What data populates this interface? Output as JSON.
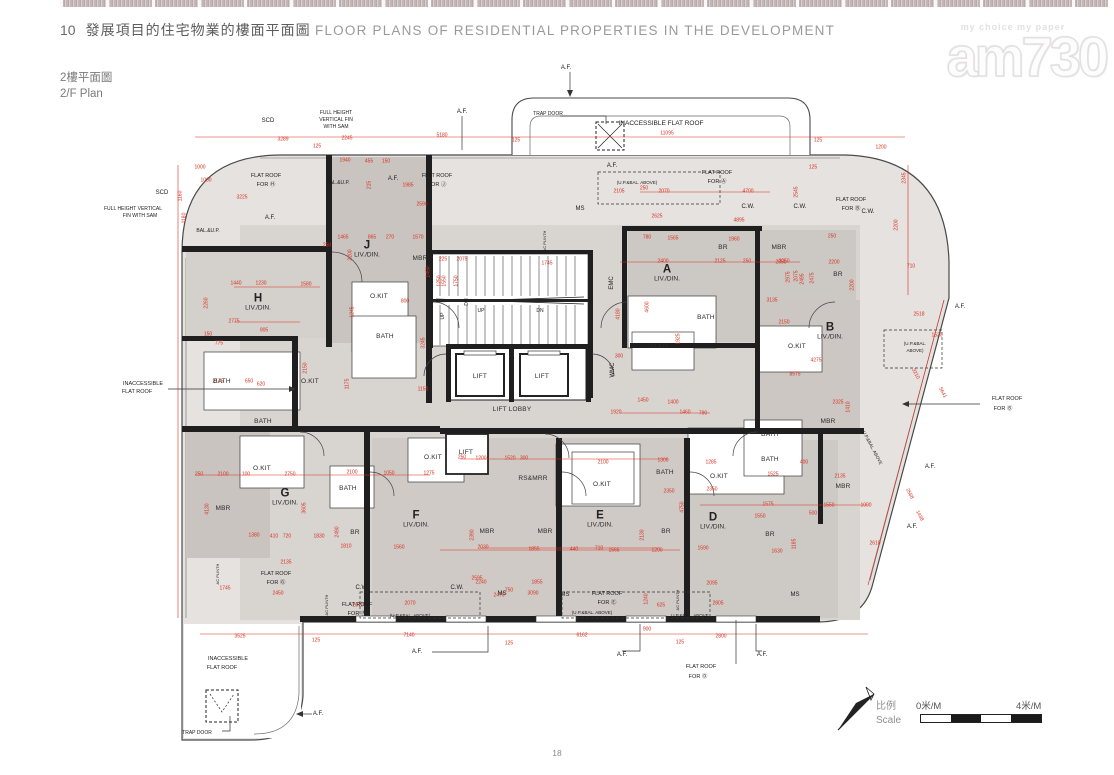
{
  "header": {
    "section_no": "10",
    "title_zh": "發展項目的住宅物業的樓面平面圖",
    "title_en": "FLOOR PLANS OF RESIDENTIAL PROPERTIES IN THE DEVELOPMENT"
  },
  "plan_title": {
    "zh": "2樓平面圖",
    "en": "2/F Plan"
  },
  "watermark": {
    "tagline": "my choice  my paper",
    "logo": "am730"
  },
  "footer": {
    "page_number": "18"
  },
  "scale_bar": {
    "label_zh": "比例",
    "label_en": "Scale",
    "start": "0米/M",
    "end": "4米/M"
  },
  "colors": {
    "dim_red": "#d9301f",
    "wall": "#1f1f1f",
    "fill_light": "#e5e2df",
    "fill_mid": "#d8d4d0",
    "fill_dark": "#c9c4c0"
  },
  "plan": {
    "units": [
      {
        "id": "H",
        "room": "LIV./DIN.",
        "x": 258,
        "y": 303
      },
      {
        "id": "J",
        "room": "LIV./DIN.",
        "x": 367,
        "y": 250
      },
      {
        "id": "A",
        "room": "LIV./DIN.",
        "x": 667,
        "y": 274
      },
      {
        "id": "B",
        "room": "LIV./DIN.",
        "x": 830,
        "y": 332
      },
      {
        "id": "G",
        "room": "LIV./DIN.",
        "x": 285,
        "y": 498
      },
      {
        "id": "F",
        "room": "LIV./DIN.",
        "x": 416,
        "y": 520
      },
      {
        "id": "E",
        "room": "LIV./DIN.",
        "x": 600,
        "y": 520
      },
      {
        "id": "D",
        "room": "LIV./DIN.",
        "x": 713,
        "y": 522
      }
    ],
    "rooms": [
      [
        "LIFT",
        480,
        377
      ],
      [
        "LIFT",
        542,
        377
      ],
      [
        "LIFT",
        466,
        453
      ],
      [
        "MBR",
        420,
        259
      ],
      [
        "MBR",
        223,
        509
      ],
      [
        "MBR",
        487,
        532
      ],
      [
        "MBR",
        545,
        532
      ],
      [
        "MBR",
        779,
        248
      ],
      [
        "MBR",
        828,
        422
      ],
      [
        "MBR",
        843,
        487
      ],
      [
        "BR",
        723,
        248
      ],
      [
        "BR",
        838,
        275
      ],
      [
        "BR",
        355,
        533
      ],
      [
        "BR",
        666,
        532
      ],
      [
        "BR",
        770,
        535
      ],
      [
        "BATH",
        222,
        382
      ],
      [
        "BATH",
        385,
        337
      ],
      [
        "BATH",
        263,
        422
      ],
      [
        "BATH",
        706,
        318
      ],
      [
        "BATH",
        348,
        489
      ],
      [
        "BATH",
        665,
        473
      ],
      [
        "BATH",
        770,
        435
      ],
      [
        "BATH",
        770,
        460
      ],
      [
        "O.KIT",
        310,
        382
      ],
      [
        "O.KIT",
        379,
        297
      ],
      [
        "O.KIT",
        660,
        347
      ],
      [
        "O.KIT",
        797,
        347
      ],
      [
        "O.KIT",
        262,
        469
      ],
      [
        "O.KIT",
        433,
        458
      ],
      [
        "O.KIT",
        602,
        485
      ],
      [
        "O.KIT",
        719,
        477
      ],
      [
        "LIFT LOBBY",
        512,
        410
      ],
      [
        "RS&MRR",
        533,
        479
      ]
    ],
    "labels": [
      [
        "SCD",
        268,
        121
      ],
      [
        "SCD",
        162,
        193
      ],
      [
        "FULL HEIGHT",
        336,
        113,
        0,
        5
      ],
      [
        "VERTICAL FIN",
        336,
        120,
        0,
        5
      ],
      [
        "WITH SAM",
        336,
        127,
        0,
        5
      ],
      [
        "FULL HEIGHT VERTICAL",
        133,
        209,
        0,
        5
      ],
      [
        "FIN WITH SAM",
        140,
        216,
        0,
        5
      ],
      [
        "TRAP DOOR",
        548,
        114,
        0,
        5
      ],
      [
        "TRAP DOOR",
        197,
        733,
        0,
        5
      ],
      [
        "INACCESSIBLE FLAT ROOF",
        661,
        124,
        0,
        6.5
      ],
      [
        "INACCESSIBLE",
        143,
        384,
        0,
        5.5
      ],
      [
        "FLAT ROOF",
        137,
        392,
        0,
        5.5
      ],
      [
        "INACCESSIBLE",
        228,
        659,
        0,
        5.5
      ],
      [
        "FLAT ROOF",
        222,
        668,
        0,
        5.5
      ],
      [
        "FLAT ROOF",
        266,
        176,
        0,
        5.5
      ],
      [
        "FOR Ⓗ",
        266,
        185,
        0,
        5.5
      ],
      [
        "FLAT ROOF",
        437,
        176,
        0,
        5.5
      ],
      [
        "FOR Ⓙ",
        437,
        185,
        0,
        5.5
      ],
      [
        "FLAT ROOF",
        717,
        173,
        0,
        5.5
      ],
      [
        "FOR Ⓐ",
        717,
        182,
        0,
        5.5
      ],
      [
        "FLAT ROOF",
        851,
        200,
        0,
        5.5
      ],
      [
        "FOR Ⓑ",
        851,
        209,
        0,
        5.5
      ],
      [
        "FLAT ROOF",
        1007,
        399,
        0,
        5.5
      ],
      [
        "FOR Ⓑ",
        1003,
        409,
        0,
        5.5
      ],
      [
        "FLAT ROOF",
        276,
        574,
        0,
        5.5
      ],
      [
        "FOR Ⓖ",
        276,
        583,
        0,
        5.5
      ],
      [
        "FLAT ROOF",
        357,
        605,
        0,
        5.5
      ],
      [
        "FOR Ⓕ",
        357,
        614,
        0,
        5.5
      ],
      [
        "FLAT ROOF",
        607,
        594,
        0,
        5.5
      ],
      [
        "FOR Ⓔ",
        607,
        603,
        0,
        5.5
      ],
      [
        "FLAT ROOF",
        701,
        667,
        0,
        5.5
      ],
      [
        "FOR Ⓓ",
        698,
        677,
        0,
        5.5
      ],
      [
        "A.F.",
        566,
        68
      ],
      [
        "A.F.",
        462,
        112
      ],
      [
        "A.F.",
        612,
        166
      ],
      [
        "A.F.",
        393,
        179
      ],
      [
        "A.F.",
        270,
        218
      ],
      [
        "A.F.",
        960,
        307
      ],
      [
        "A.F.",
        930,
        467
      ],
      [
        "A.F.",
        912,
        527
      ],
      [
        "A.F.",
        417,
        652
      ],
      [
        "A.F.",
        622,
        655
      ],
      [
        "A.F.",
        762,
        655
      ],
      [
        "A.F.",
        318,
        714
      ],
      [
        "C.W.",
        748,
        207
      ],
      [
        "C.W.",
        800,
        207
      ],
      [
        "C.W.",
        868,
        212
      ],
      [
        "C.W.",
        362,
        588
      ],
      [
        "C.W.",
        457,
        588
      ],
      [
        "MS",
        580,
        209
      ],
      [
        "MS",
        502,
        594
      ],
      [
        "MS",
        565,
        595
      ],
      [
        "MS",
        795,
        595
      ],
      [
        "EMC",
        612,
        283,
        -90
      ],
      [
        "WMC",
        613,
        370,
        -90
      ],
      [
        "PD",
        658,
        433
      ],
      [
        "AC PLINTH",
        545,
        241,
        -90,
        4
      ],
      [
        "AC PLINTH",
        218,
        574,
        -90,
        4
      ],
      [
        "AC PLINTH",
        327,
        605,
        -90,
        4
      ],
      [
        "AC PLINTH",
        678,
        600,
        -90,
        4
      ],
      [
        "UP",
        481,
        311,
        0,
        5
      ],
      [
        "DN",
        540,
        311,
        0,
        5
      ],
      [
        "UP",
        443,
        316,
        -90,
        5
      ],
      [
        "UP",
        592,
        300,
        -90,
        5
      ],
      [
        "DN",
        467,
        302,
        -90,
        5
      ],
      [
        "(U.P.&BAL. ABOVE)",
        637,
        183,
        0,
        4.5
      ],
      [
        "(U.P.&BAL.",
        915,
        344,
        0,
        4.5
      ],
      [
        "ABOVE)",
        915,
        351,
        0,
        4.5
      ],
      [
        "(U.P.&BAL. ABOVE)",
        410,
        616,
        0,
        4.5
      ],
      [
        "(U.P.&BAL. ABOVE)",
        592,
        613,
        0,
        4.5
      ],
      [
        "U.P.&BAL. ABOVE",
        690,
        616,
        0,
        4.5
      ],
      [
        "U.P.&BAL. ABOVE",
        872,
        448,
        62,
        4.5
      ],
      [
        "BAL.&U.P.",
        208,
        231,
        0,
        5
      ],
      [
        "BAL.&U.P.",
        338,
        183,
        0,
        5
      ]
    ],
    "dims": [
      [
        "3289",
        283,
        140
      ],
      [
        "125",
        317,
        147
      ],
      [
        "2245",
        347,
        139
      ],
      [
        "5180",
        442,
        136
      ],
      [
        "125",
        516,
        141
      ],
      [
        "11095",
        667,
        134
      ],
      [
        "125",
        818,
        141
      ],
      [
        "1200",
        881,
        148
      ],
      [
        "1000",
        200,
        168
      ],
      [
        "1000",
        206,
        181
      ],
      [
        "3225",
        242,
        198
      ],
      [
        "1940",
        345,
        161
      ],
      [
        "455",
        369,
        162
      ],
      [
        "150",
        386,
        162
      ],
      [
        "1985",
        408,
        186
      ],
      [
        "2590",
        422,
        205
      ],
      [
        "215",
        370,
        185,
        -90
      ],
      [
        "1160",
        181,
        196,
        -90
      ],
      [
        "1180",
        185,
        218,
        -90
      ],
      [
        "1440",
        236,
        284
      ],
      [
        "1230",
        261,
        284
      ],
      [
        "1580",
        306,
        285
      ],
      [
        "250",
        327,
        246
      ],
      [
        "2775",
        234,
        322
      ],
      [
        "905",
        264,
        331
      ],
      [
        "150",
        208,
        335
      ],
      [
        "775",
        219,
        344
      ],
      [
        "2260",
        207,
        303,
        -90
      ],
      [
        "2150",
        306,
        368,
        -90
      ],
      [
        "2175",
        218,
        382
      ],
      [
        "650",
        249,
        382
      ],
      [
        "620",
        261,
        385
      ],
      [
        "1465",
        343,
        238
      ],
      [
        "865",
        372,
        238
      ],
      [
        "270",
        390,
        238
      ],
      [
        "1570",
        418,
        238
      ],
      [
        "2200",
        351,
        255,
        -90
      ],
      [
        "1450",
        429,
        272,
        -90
      ],
      [
        "1250",
        440,
        281,
        -90
      ],
      [
        "800",
        405,
        302
      ],
      [
        "1245",
        353,
        312,
        -90
      ],
      [
        "3245",
        424,
        343,
        -90
      ],
      [
        "1175",
        348,
        384,
        -90
      ],
      [
        "1150",
        423,
        390
      ],
      [
        "225",
        443,
        260
      ],
      [
        "2075",
        462,
        260
      ],
      [
        "1745",
        547,
        264
      ],
      [
        "2400",
        663,
        262
      ],
      [
        "4180",
        619,
        314,
        -90
      ],
      [
        "4600",
        648,
        307,
        -90
      ],
      [
        "300",
        619,
        357
      ],
      [
        "1550",
        445,
        281,
        -90
      ],
      [
        "1750",
        457,
        281,
        -90
      ],
      [
        "1925",
        679,
        339,
        -90
      ],
      [
        "1450",
        643,
        401
      ],
      [
        "1400",
        673,
        403
      ],
      [
        "1920",
        616,
        413
      ],
      [
        "1460",
        685,
        413
      ],
      [
        "790",
        703,
        414
      ],
      [
        "2105",
        619,
        192
      ],
      [
        "250",
        644,
        189
      ],
      [
        "2070",
        664,
        192
      ],
      [
        "4700",
        748,
        192
      ],
      [
        "2545",
        797,
        192,
        -90
      ],
      [
        "2625",
        657,
        217
      ],
      [
        "4895",
        739,
        221
      ],
      [
        "780",
        647,
        238
      ],
      [
        "1565",
        673,
        239
      ],
      [
        "1960",
        734,
        240
      ],
      [
        "2125",
        720,
        262
      ],
      [
        "250",
        747,
        262
      ],
      [
        "2050",
        784,
        262
      ],
      [
        "2075",
        797,
        276,
        -90
      ],
      [
        "2475",
        813,
        278,
        -90
      ],
      [
        "250",
        832,
        237
      ],
      [
        "125",
        813,
        168
      ],
      [
        "2345",
        905,
        178,
        -90
      ],
      [
        "2200",
        897,
        225,
        -90
      ],
      [
        "2050",
        781,
        263
      ],
      [
        "2200",
        834,
        263
      ],
      [
        "2975",
        789,
        277,
        -90
      ],
      [
        "2495",
        803,
        279,
        -90
      ],
      [
        "2200",
        853,
        285,
        -90
      ],
      [
        "710",
        911,
        267
      ],
      [
        "3135",
        772,
        301
      ],
      [
        "2150",
        784,
        323
      ],
      [
        "2518",
        919,
        315
      ],
      [
        "1520",
        937,
        336
      ],
      [
        "4275",
        816,
        361
      ],
      [
        "8575",
        795,
        375
      ],
      [
        "2325",
        838,
        403
      ],
      [
        "1410",
        849,
        407,
        -90
      ],
      [
        "5641",
        942,
        393,
        62
      ],
      [
        "3210",
        915,
        374,
        62
      ],
      [
        "250",
        199,
        475
      ],
      [
        "2100",
        223,
        475
      ],
      [
        "100",
        246,
        475
      ],
      [
        "2750",
        290,
        475
      ],
      [
        "2100",
        352,
        473
      ],
      [
        "1050",
        389,
        474
      ],
      [
        "1275",
        429,
        474
      ],
      [
        "4130",
        208,
        509,
        -90
      ],
      [
        "3605",
        305,
        508,
        -90
      ],
      [
        "1380",
        254,
        536
      ],
      [
        "410",
        274,
        537
      ],
      [
        "720",
        287,
        537
      ],
      [
        "1830",
        319,
        537
      ],
      [
        "2135",
        286,
        563
      ],
      [
        "1810",
        346,
        547
      ],
      [
        "1560",
        399,
        548
      ],
      [
        "2490",
        338,
        532,
        -90
      ],
      [
        "2450",
        278,
        594
      ],
      [
        "1745",
        225,
        589
      ],
      [
        "2070",
        358,
        606
      ],
      [
        "250",
        462,
        458
      ],
      [
        "1200",
        481,
        459
      ],
      [
        "1520",
        510,
        459
      ],
      [
        "300",
        524,
        459
      ],
      [
        "2100",
        603,
        463
      ],
      [
        "1300",
        663,
        461
      ],
      [
        "2350",
        669,
        492
      ],
      [
        "2030",
        483,
        548
      ],
      [
        "1855",
        534,
        550
      ],
      [
        "440",
        574,
        550
      ],
      [
        "710",
        599,
        549
      ],
      [
        "1565",
        614,
        551
      ],
      [
        "1200",
        657,
        551
      ],
      [
        "2390",
        473,
        535,
        -90
      ],
      [
        "2130",
        643,
        535,
        -90
      ],
      [
        "4750",
        683,
        507,
        -90
      ],
      [
        "2240",
        481,
        583
      ],
      [
        "750",
        509,
        591
      ],
      [
        "2470",
        499,
        596
      ],
      [
        "1855",
        537,
        583
      ],
      [
        "3090",
        533,
        594
      ],
      [
        "1240",
        647,
        599,
        -90
      ],
      [
        "625",
        661,
        606
      ],
      [
        "1285",
        711,
        463
      ],
      [
        "1525",
        773,
        475
      ],
      [
        "2135",
        840,
        477
      ],
      [
        "2350",
        712,
        490
      ],
      [
        "400",
        804,
        463
      ],
      [
        "1575",
        768,
        505
      ],
      [
        "1550",
        760,
        517
      ],
      [
        "500",
        813,
        514
      ],
      [
        "1550",
        829,
        506
      ],
      [
        "1000",
        866,
        506
      ],
      [
        "1590",
        703,
        549
      ],
      [
        "1630",
        777,
        552
      ],
      [
        "1185",
        795,
        544,
        -90
      ],
      [
        "2610",
        875,
        544
      ],
      [
        "2568",
        909,
        494,
        62
      ],
      [
        "1438",
        919,
        516,
        62
      ],
      [
        "2095",
        712,
        584
      ],
      [
        "2595",
        477,
        579
      ],
      [
        "2070",
        410,
        604
      ],
      [
        "7140",
        409,
        636
      ],
      [
        "125",
        316,
        641
      ],
      [
        "6162",
        582,
        636
      ],
      [
        "125",
        509,
        644
      ],
      [
        "900",
        647,
        630
      ],
      [
        "2800",
        721,
        637
      ],
      [
        "125",
        680,
        643
      ],
      [
        "2805",
        718,
        604
      ],
      [
        "3525",
        240,
        637
      ]
    ]
  }
}
